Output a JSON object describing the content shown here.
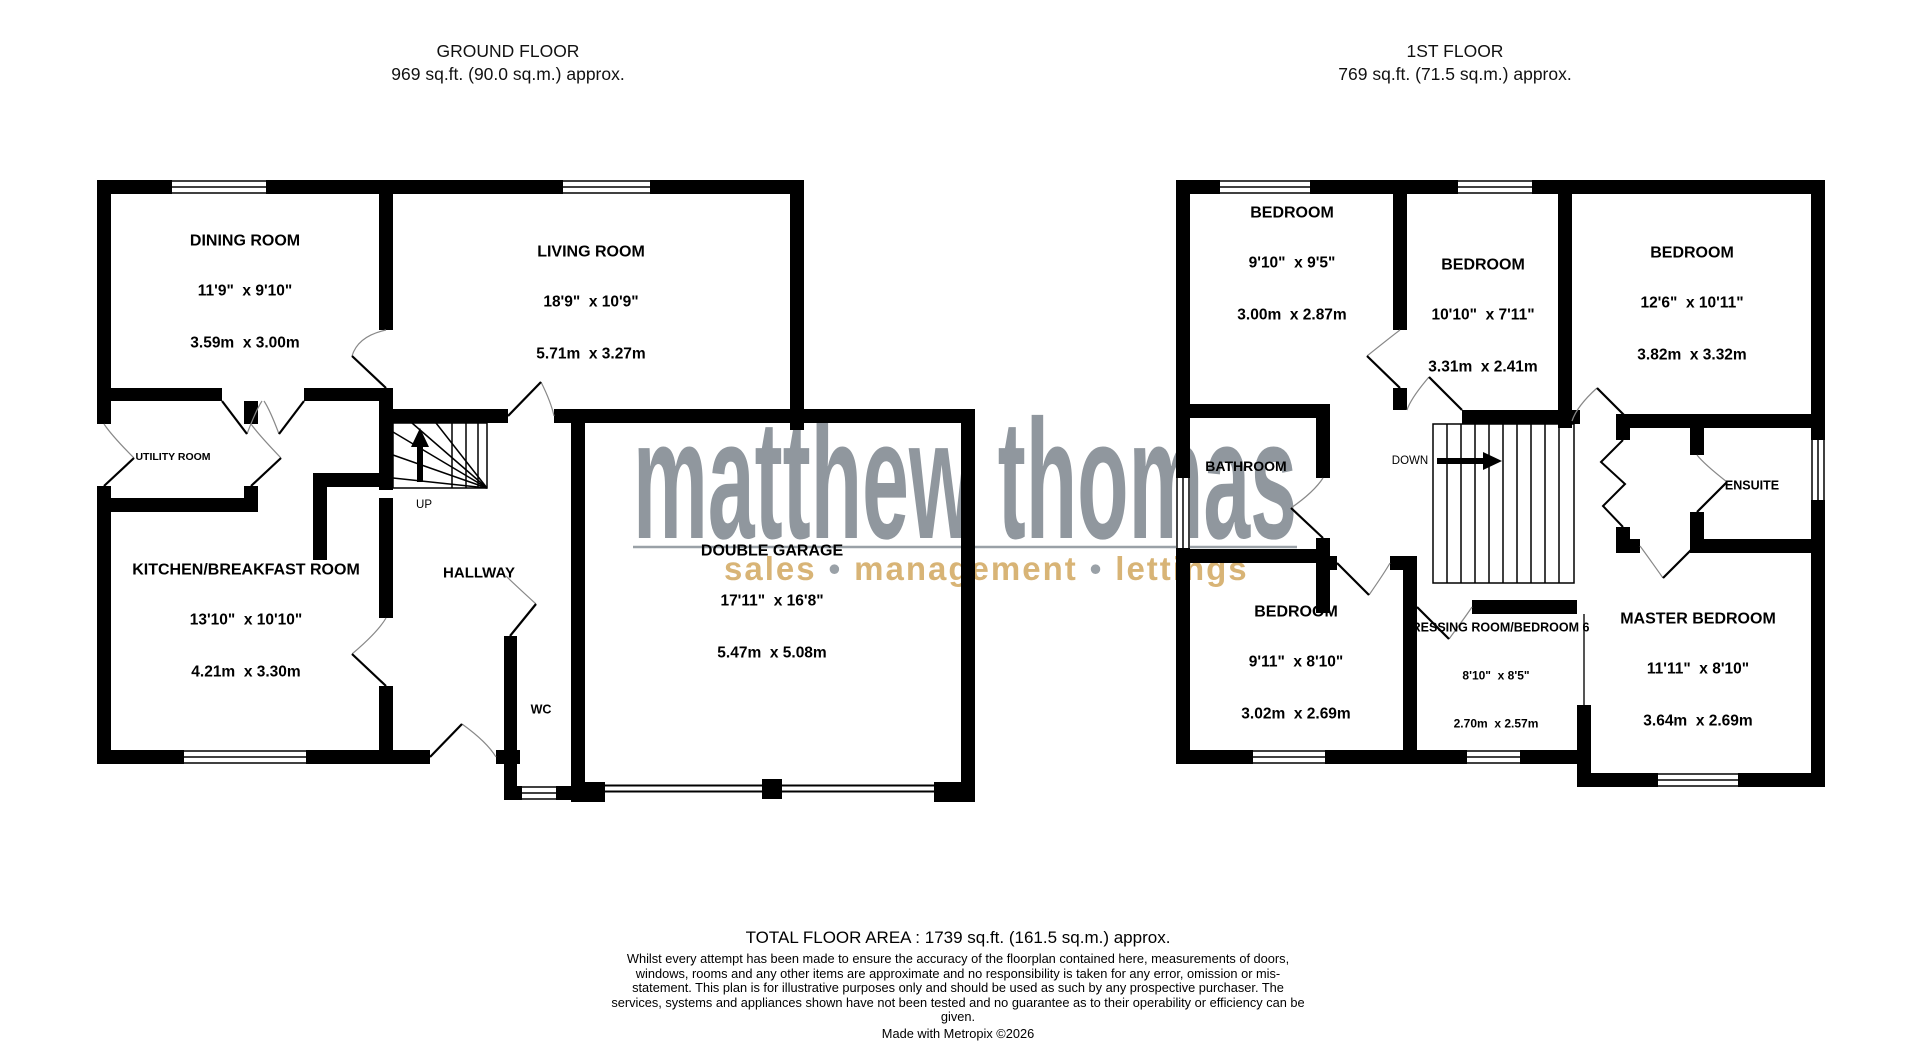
{
  "header": {
    "ground_title": "GROUND FLOOR",
    "ground_area": "969 sq.ft. (90.0 sq.m.) approx.",
    "first_title": "1ST FLOOR",
    "first_area": "769 sq.ft. (71.5 sq.m.) approx."
  },
  "watermark": {
    "brand": "matthew thomas",
    "tagline_parts": [
      "sales",
      "management",
      "lettings"
    ],
    "tagline_separator": "•",
    "brand_color": "#8a9199",
    "tagline_color": "#d8b476"
  },
  "ground_floor": {
    "stairs_label": "UP",
    "rooms": {
      "dining": {
        "name": "DINING ROOM",
        "imperial": "11'9\"  x 9'10\"",
        "metric": "3.59m  x 3.00m"
      },
      "living": {
        "name": "LIVING ROOM",
        "imperial": "18'9\"  x 10'9\"",
        "metric": "5.71m  x 3.27m"
      },
      "utility": {
        "name": "UTILITY ROOM"
      },
      "kitchen": {
        "name": "KITCHEN/BREAKFAST ROOM",
        "imperial": "13'10\"  x 10'10\"",
        "metric": "4.21m  x 3.30m"
      },
      "hallway": {
        "name": "HALLWAY"
      },
      "wc": {
        "name": "WC"
      },
      "garage": {
        "name": "DOUBLE GARAGE",
        "imperial": "17'11\"  x 16'8\"",
        "metric": "5.47m  x 5.08m"
      }
    }
  },
  "first_floor": {
    "stairs_label": "DOWN",
    "rooms": {
      "bedroom1": {
        "name": "BEDROOM",
        "imperial": "9'10\"  x 9'5\"",
        "metric": "3.00m  x 2.87m"
      },
      "bedroom2": {
        "name": "BEDROOM",
        "imperial": "10'10\"  x 7'11\"",
        "metric": "3.31m  x 2.41m"
      },
      "bedroom3": {
        "name": "BEDROOM",
        "imperial": "12'6\"  x 10'11\"",
        "metric": "3.82m  x 3.32m"
      },
      "bathroom": {
        "name": "BATHROOM"
      },
      "ensuite": {
        "name": "ENSUITE"
      },
      "bedroom4": {
        "name": "BEDROOM",
        "imperial": "9'11\"  x 8'10\"",
        "metric": "3.02m  x 2.69m"
      },
      "dressing": {
        "name": "DRESSING ROOM/BEDROOM 6",
        "imperial": "8'10\"  x 8'5\"",
        "metric": "2.70m  x 2.57m"
      },
      "master": {
        "name": "MASTER BEDROOM",
        "imperial": "11'11\"  x 8'10\"",
        "metric": "3.64m  x 2.69m"
      }
    }
  },
  "footer": {
    "total": "TOTAL FLOOR AREA : 1739 sq.ft. (161.5 sq.m.) approx.",
    "disclaimer": "Whilst every attempt has been made to ensure the accuracy of the floorplan contained here, measurements of doors, windows, rooms and any other items are approximate and no responsibility is taken for any error, omission or mis-statement. This plan is for illustrative purposes only and should be used as such by any prospective purchaser. The services, systems and appliances shown have not been tested and no guarantee as to their operability or efficiency can be given.",
    "credit": "Made with Metropix ©2026"
  }
}
